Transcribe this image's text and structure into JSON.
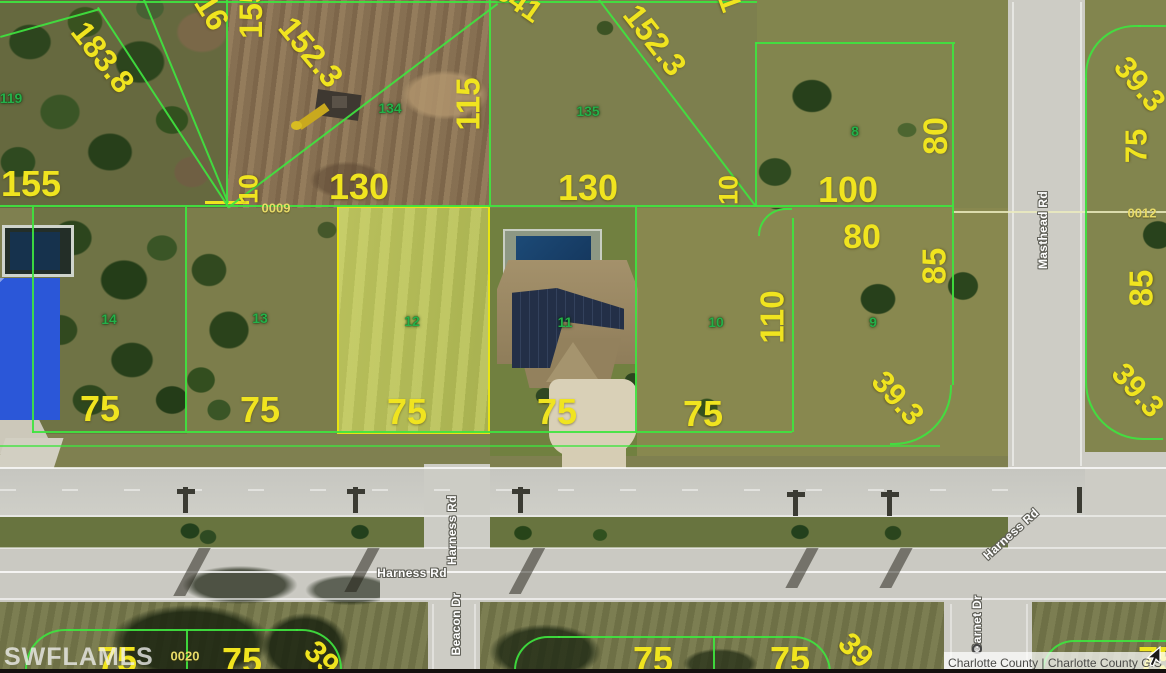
{
  "map": {
    "attribution": "Charlotte County | Charlotte County GIS",
    "watermark": "SWFLAMLS",
    "colors": {
      "parcel_line": "#3fe43f",
      "dimension_text": "#f0e41f",
      "lot_text": "#25b04a",
      "selected_parcel_outline": "#e8e413",
      "road_label_text": "#ffffff"
    },
    "selected_parcel": "12",
    "labels": [
      {
        "kind": "dim",
        "text": "155",
        "x": 31,
        "y": 184,
        "rot": 0,
        "size": 36
      },
      {
        "kind": "dim",
        "text": "183.8",
        "x": 103,
        "y": 57,
        "rot": 52,
        "size": 32
      },
      {
        "kind": "dim",
        "text": "16",
        "x": 212,
        "y": 12,
        "rot": 58,
        "size": 32
      },
      {
        "kind": "dim",
        "text": "155",
        "x": 251,
        "y": 12,
        "rot": -90,
        "size": 32
      },
      {
        "kind": "dim",
        "text": "152.3",
        "x": 311,
        "y": 52,
        "rot": 50,
        "size": 32
      },
      {
        "kind": "dim",
        "text": "341",
        "x": 518,
        "y": 2,
        "rot": 35,
        "size": 30
      },
      {
        "kind": "dim",
        "text": "115",
        "x": 468,
        "y": 104,
        "rot": -90,
        "size": 33
      },
      {
        "kind": "dim",
        "text": "152.3",
        "x": 655,
        "y": 40,
        "rot": 52,
        "size": 32
      },
      {
        "kind": "dim",
        "text": "1",
        "x": 729,
        "y": 3,
        "rot": 70,
        "size": 30
      },
      {
        "kind": "dim",
        "text": "10",
        "x": 249,
        "y": 189,
        "rot": -90,
        "size": 27
      },
      {
        "kind": "dim",
        "text": "130",
        "x": 359,
        "y": 187,
        "rot": 0,
        "size": 36
      },
      {
        "kind": "dim",
        "text": "130",
        "x": 588,
        "y": 188,
        "rot": 0,
        "size": 36
      },
      {
        "kind": "dim",
        "text": "10",
        "x": 729,
        "y": 190,
        "rot": -90,
        "size": 27
      },
      {
        "kind": "dim",
        "text": "100",
        "x": 848,
        "y": 190,
        "rot": 0,
        "size": 36
      },
      {
        "kind": "dim",
        "text": "80",
        "x": 862,
        "y": 237,
        "rot": 0,
        "size": 34
      },
      {
        "kind": "dim",
        "text": "80",
        "x": 936,
        "y": 136,
        "rot": -90,
        "size": 34
      },
      {
        "kind": "dim",
        "text": "85",
        "x": 934,
        "y": 266,
        "rot": -90,
        "size": 33
      },
      {
        "kind": "dim",
        "text": "110",
        "x": 772,
        "y": 317,
        "rot": -90,
        "size": 33
      },
      {
        "kind": "dim",
        "text": "39.3",
        "x": 1140,
        "y": 84,
        "rot": 50,
        "size": 31
      },
      {
        "kind": "dim",
        "text": "75",
        "x": 1136,
        "y": 146,
        "rot": -90,
        "size": 31
      },
      {
        "kind": "dim",
        "text": "85",
        "x": 1141,
        "y": 288,
        "rot": -90,
        "size": 33
      },
      {
        "kind": "dim",
        "text": "39.3",
        "x": 1138,
        "y": 390,
        "rot": 48,
        "size": 31
      },
      {
        "kind": "dim",
        "text": "39.3",
        "x": 898,
        "y": 398,
        "rot": 48,
        "size": 31
      },
      {
        "kind": "dim",
        "text": "75",
        "x": 100,
        "y": 409,
        "rot": 0,
        "size": 36
      },
      {
        "kind": "dim",
        "text": "75",
        "x": 260,
        "y": 410,
        "rot": 0,
        "size": 36
      },
      {
        "kind": "dim",
        "text": "75",
        "x": 407,
        "y": 412,
        "rot": 0,
        "size": 36
      },
      {
        "kind": "dim",
        "text": "75",
        "x": 557,
        "y": 412,
        "rot": 0,
        "size": 36
      },
      {
        "kind": "dim",
        "text": "75",
        "x": 703,
        "y": 414,
        "rot": 0,
        "size": 36
      },
      {
        "kind": "dim",
        "text": "75",
        "x": 117,
        "y": 660,
        "rot": 0,
        "size": 36
      },
      {
        "kind": "dim",
        "text": "75",
        "x": 242,
        "y": 661,
        "rot": 0,
        "size": 36
      },
      {
        "kind": "dim",
        "text": "39",
        "x": 322,
        "y": 658,
        "rot": 45,
        "size": 31
      },
      {
        "kind": "dim",
        "text": "75",
        "x": 653,
        "y": 660,
        "rot": 0,
        "size": 36
      },
      {
        "kind": "dim",
        "text": "75",
        "x": 790,
        "y": 660,
        "rot": 0,
        "size": 36
      },
      {
        "kind": "dim",
        "text": "39",
        "x": 856,
        "y": 650,
        "rot": 45,
        "size": 31
      },
      {
        "kind": "dim",
        "text": "75",
        "x": 1158,
        "y": 660,
        "rot": 0,
        "size": 36
      },
      {
        "kind": "sec",
        "text": "0009",
        "x": 276,
        "y": 208,
        "rot": 0,
        "size": 13
      },
      {
        "kind": "sec",
        "text": "0012",
        "x": 1142,
        "y": 213,
        "rot": 0,
        "size": 13
      },
      {
        "kind": "sec",
        "text": "0020",
        "x": 185,
        "y": 656,
        "rot": 0,
        "size": 13
      },
      {
        "kind": "lot",
        "text": "119",
        "x": 11,
        "y": 98,
        "rot": 0,
        "size": 14
      },
      {
        "kind": "lot",
        "text": "134",
        "x": 390,
        "y": 108,
        "rot": 0,
        "size": 14
      },
      {
        "kind": "lot",
        "text": "135",
        "x": 588,
        "y": 111,
        "rot": 0,
        "size": 14
      },
      {
        "kind": "lot",
        "text": "8",
        "x": 855,
        "y": 131,
        "rot": 0,
        "size": 14
      },
      {
        "kind": "lot",
        "text": "14",
        "x": 109,
        "y": 319,
        "rot": 0,
        "size": 14
      },
      {
        "kind": "lot",
        "text": "13",
        "x": 260,
        "y": 318,
        "rot": 0,
        "size": 14
      },
      {
        "kind": "lot",
        "text": "12",
        "x": 412,
        "y": 321,
        "rot": 0,
        "size": 14
      },
      {
        "kind": "lot",
        "text": "11",
        "x": 565,
        "y": 322,
        "rot": 0,
        "size": 14
      },
      {
        "kind": "lot",
        "text": "10",
        "x": 716,
        "y": 322,
        "rot": 0,
        "size": 14
      },
      {
        "kind": "lot",
        "text": "9",
        "x": 873,
        "y": 322,
        "rot": 0,
        "size": 14
      },
      {
        "kind": "road",
        "text": "Masthead Rd",
        "x": 1043,
        "y": 230,
        "rot": -90,
        "size": 12
      },
      {
        "kind": "road",
        "text": "Harness Rd",
        "x": 452,
        "y": 530,
        "rot": -90,
        "size": 12
      },
      {
        "kind": "road",
        "text": "Harness Rd",
        "x": 412,
        "y": 573,
        "rot": 0,
        "size": 12
      },
      {
        "kind": "road",
        "text": "Harness Rd",
        "x": 1011,
        "y": 534,
        "rot": -42,
        "size": 12
      },
      {
        "kind": "road",
        "text": "Beacon Dr",
        "x": 456,
        "y": 624,
        "rot": -90,
        "size": 12
      },
      {
        "kind": "road",
        "text": "Garnet Dr",
        "x": 977,
        "y": 624,
        "rot": -90,
        "size": 12
      }
    ]
  }
}
